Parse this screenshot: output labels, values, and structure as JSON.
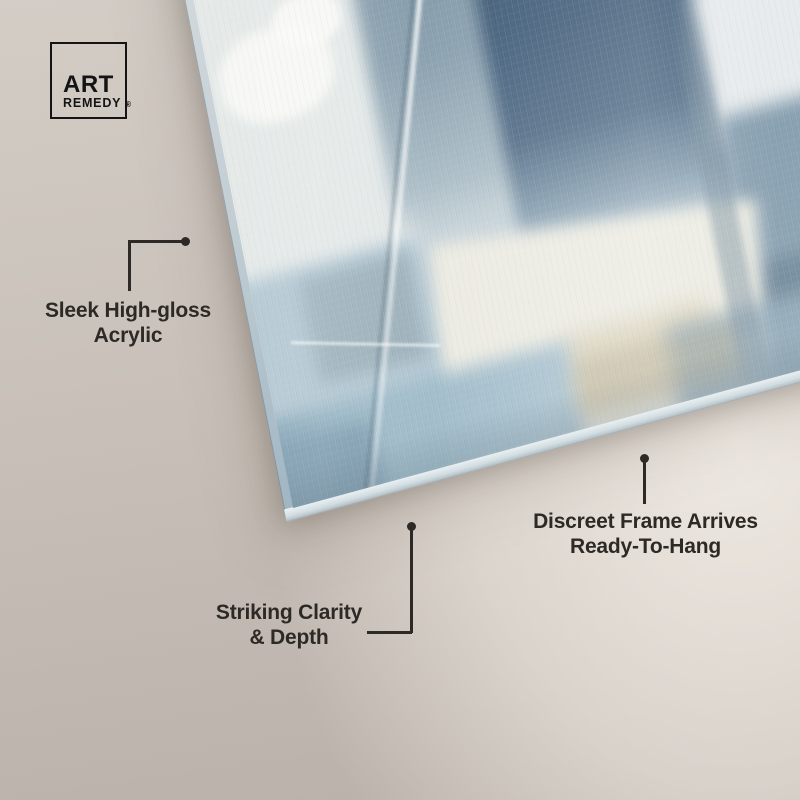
{
  "brand": {
    "name_line1": "ART",
    "name_line2": "REMEDY",
    "registered_mark": "®"
  },
  "callouts": [
    {
      "id": "acrylic",
      "label": "Sleek High-gloss Acrylic",
      "lines": [
        "Sleek High-gloss",
        "Acrylic"
      ]
    },
    {
      "id": "clarity",
      "label": "Striking Clarity & Depth",
      "lines": [
        "Striking Clarity",
        "& Depth"
      ]
    },
    {
      "id": "frame",
      "label": "Discreet Frame Arrives Ready-To-Hang",
      "lines": [
        "Discreet Frame Arrives",
        "Ready-To-Hang"
      ]
    }
  ],
  "artwork": {
    "description": "Tilted abstract acrylic art panel with soft square blocks of blue, slate, ivory and cream brushwork",
    "palette": {
      "dark_slate": "#44607b",
      "slate_blue": "#8ca2b0",
      "pale_blue": "#b5cad4",
      "steel_blue": "#84a3b5",
      "ivory": "#edece3",
      "cream": "#d8cfb5",
      "pale_gray": "#e4e9e8"
    }
  },
  "colors": {
    "background_left": "#bdb5ad",
    "background_top": "#d3cdc6",
    "background_right": "#e4dfd8",
    "text": "#2d2a26",
    "connector": "#2d2a26",
    "logo": "#141414"
  }
}
